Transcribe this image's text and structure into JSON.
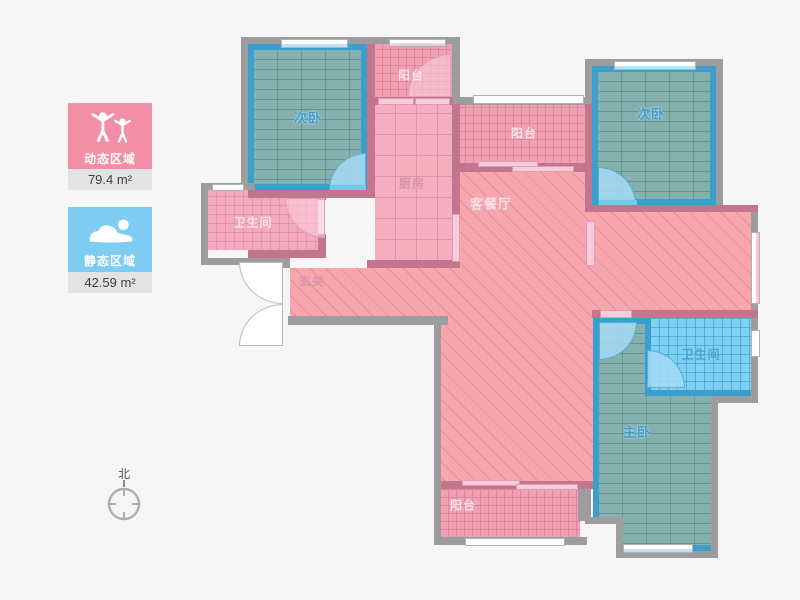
{
  "legend": {
    "dynamic": {
      "label": "动态区域",
      "area": "79.4 m²",
      "color": "#f28fa6",
      "icon": "people-cheering-icon"
    },
    "static": {
      "label": "静态区域",
      "area": "42.59 m²",
      "color": "#7fccf3",
      "icon": "person-sleeping-icon"
    }
  },
  "compass": {
    "label": "北"
  },
  "rooms": {
    "bedroom_left": {
      "label": "次卧",
      "type": "secondary-bedroom"
    },
    "balcony_top": {
      "label": "阳台",
      "type": "balcony"
    },
    "kitchen": {
      "label": "厨房",
      "type": "kitchen"
    },
    "bathroom_left": {
      "label": "卫生间",
      "type": "bathroom"
    },
    "hallway": {
      "label": "玄关",
      "type": "entry"
    },
    "living": {
      "label": "客餐厅",
      "type": "living-dining"
    },
    "balcony_middle": {
      "label": "阳台",
      "type": "balcony"
    },
    "bedroom_right": {
      "label": "次卧",
      "type": "secondary-bedroom"
    },
    "bathroom_right": {
      "label": "卫生间",
      "type": "bathroom"
    },
    "master_bedroom": {
      "label": "主卧",
      "type": "master-bedroom"
    },
    "balcony_bottom": {
      "label": "阳台",
      "type": "balcony"
    }
  },
  "colors": {
    "wall_outer": "#9d9d9d",
    "wall_inner": "#c3758c",
    "wall_blue": "#3a9ecf",
    "floor_pink": "#f7a6ae",
    "floor_teal": "#75a8a5",
    "floor_blue_tile": "#7fd1f3",
    "page_background": "#f6f6f6"
  }
}
